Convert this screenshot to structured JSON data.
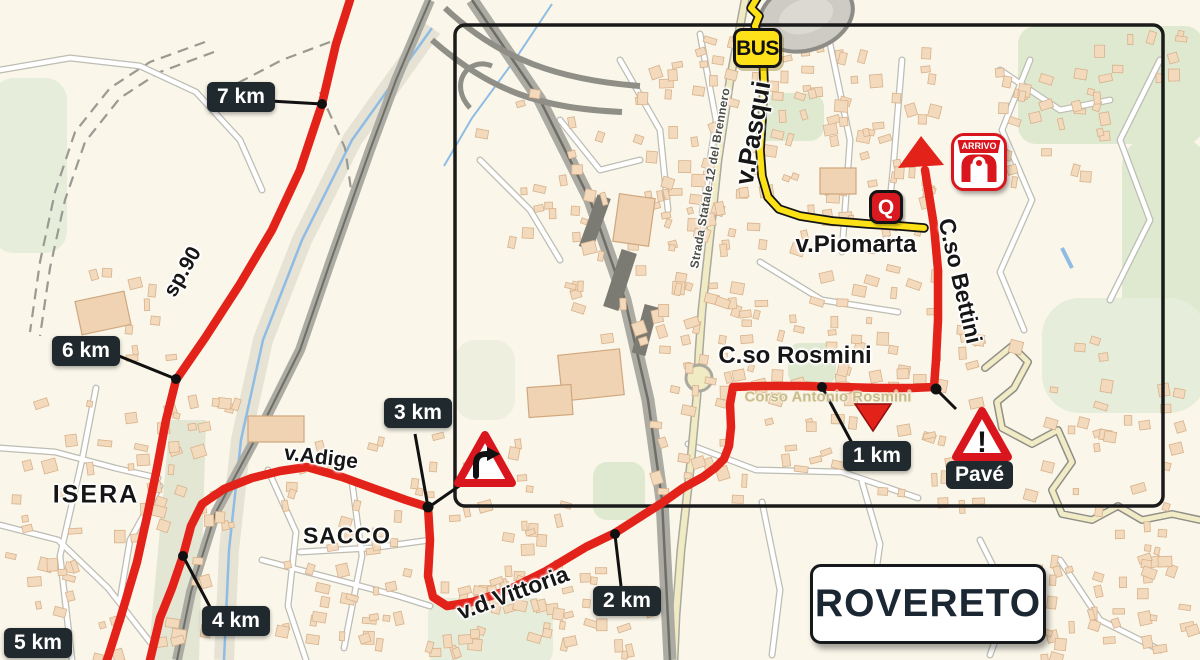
{
  "city_sign": "ROVERETO",
  "place_labels": {
    "isera": "ISERA",
    "sacco": "SACCO"
  },
  "road_labels": {
    "sp90": "sp.90",
    "adige": "v.Adige",
    "vittoria": "v.d.Vittoria",
    "rosmini": "C.so Rosmini",
    "rosmini_full": "Corso Antonio Rosmini",
    "pasqui": "v.Pasqui",
    "piomarta": "v.Piomarta",
    "bettini": "C.so Bettini",
    "brennero": "Strada Statale 12 del Brennero"
  },
  "badges": {
    "bus": "BUS",
    "quartiere": "Q",
    "arrivo": "ARRIVO"
  },
  "hazards": {
    "pave": "Pavé"
  },
  "km_markers": [
    {
      "label": "7 km"
    },
    {
      "label": "6 km"
    },
    {
      "label": "5 km"
    },
    {
      "label": "4 km"
    },
    {
      "label": "3 km"
    },
    {
      "label": "2 km"
    },
    {
      "label": "1 km"
    }
  ],
  "colors": {
    "route_red": "#E3231A",
    "bus_route_yellow": "#FBE116",
    "km_box": "#20292E",
    "warning_red": "#D9161E",
    "sign_text": "#1B2733",
    "map_background": "#FAF6E9"
  }
}
